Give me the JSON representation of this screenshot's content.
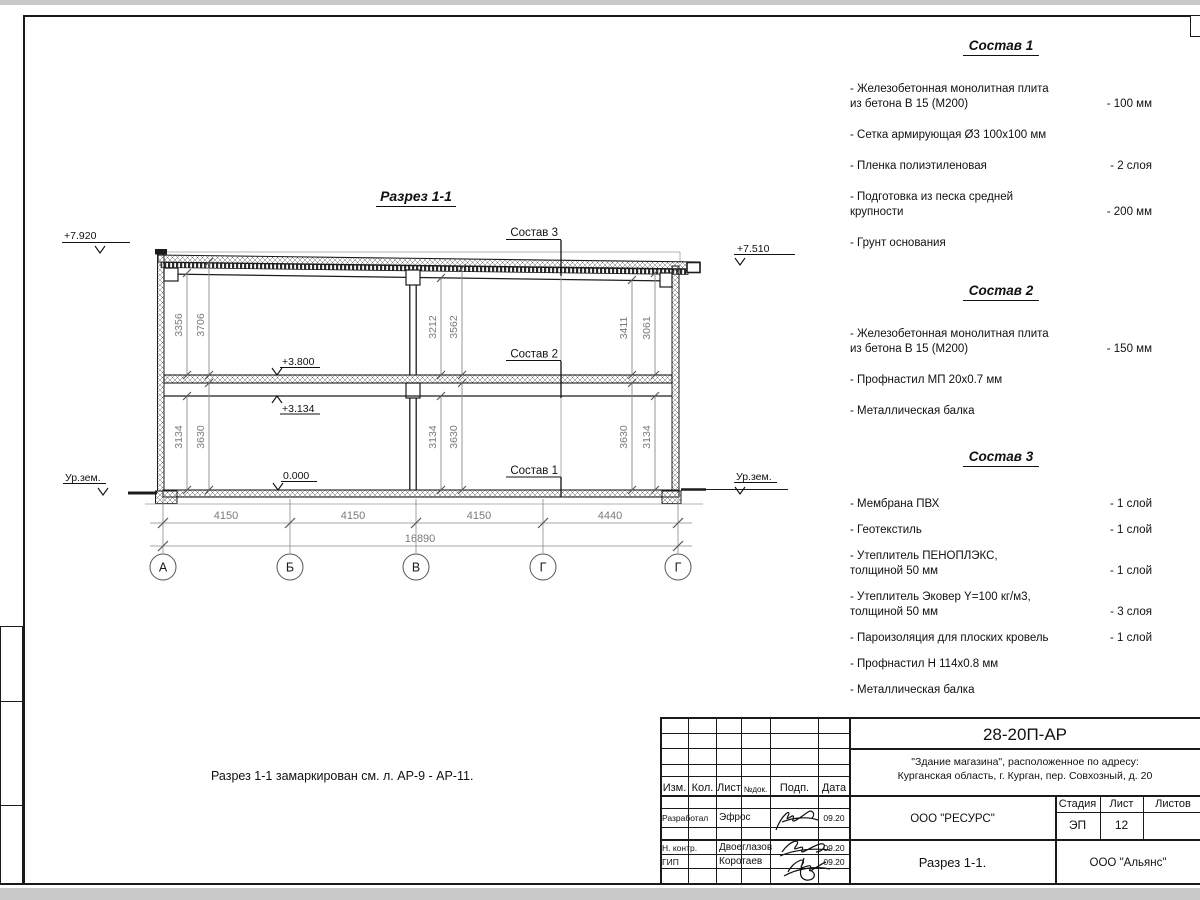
{
  "sheet": {
    "note": "Разрез 1-1 замаркирован см. л. АР-9 - АР-11."
  },
  "section": {
    "title": "Разрез 1-1",
    "levels": {
      "l7920": "+7.920",
      "l7510": "+7.510",
      "l3800": "+3.800",
      "l3134": "+3.134",
      "l0000": "0.000",
      "ground_left": "Ур.зем.",
      "ground_right": "Ур.зем."
    },
    "callouts": {
      "c1": "Состав 1",
      "c2": "Состав 2",
      "c3": "Состав 3"
    },
    "vdims": {
      "lu1": "3356",
      "lu2": "3706",
      "mu1": "3212",
      "mu2": "3562",
      "ru1": "3411",
      "ru2": "3061",
      "ll1": "3134",
      "ll2": "3630",
      "ml1": "3134",
      "ml2": "3630",
      "rl1": "3630",
      "rl2": "3134"
    },
    "hdims": {
      "d1": "4150",
      "d2": "4150",
      "d3": "4150",
      "d4": "4440",
      "total": "16890"
    },
    "axes": {
      "a1": "А",
      "a2": "Б",
      "a3": "В",
      "a4": "Г",
      "a5": "Г"
    }
  },
  "compositions": [
    {
      "title": "Состав 1",
      "items": [
        {
          "text": "- Железобетонная  монолитная плита\nиз бетона В 15 (М200)",
          "value": "- 100 мм"
        },
        {
          "text": "- Сетка армирующая Ø3 100х100 мм",
          "value": ""
        },
        {
          "text": "- Пленка полиэтиленовая",
          "value": "-  2 слоя"
        },
        {
          "text": "- Подготовка из песка средней\nкрупности",
          "value": "- 200 мм"
        },
        {
          "text": "- Грунт основания",
          "value": ""
        }
      ]
    },
    {
      "title": "Состав 2",
      "items": [
        {
          "text": "- Железобетонная  монолитная плита\nиз бетона В 15 (М200)",
          "value": "- 150 мм"
        },
        {
          "text": "- Профнастил МП 20х0.7 мм",
          "value": ""
        },
        {
          "text": "- Металлическая балка",
          "value": ""
        }
      ]
    },
    {
      "title": "Состав 3",
      "items": [
        {
          "text": "- Мембрана ПВХ",
          "value": "- 1 слой"
        },
        {
          "text": "- Геотекстиль",
          "value": "- 1 слой"
        },
        {
          "text": "- Утеплитель ПЕНОПЛЭКС,\nтолщиной 50 мм",
          "value": "- 1 слой"
        },
        {
          "text": "- Утеплитель Эковер Y=100 кг/м3,\nтолщиной 50 мм",
          "value": "- 3 слоя"
        },
        {
          "text": "- Пароизоляция для плоских кровель",
          "value": "- 1 слой"
        },
        {
          "text": "- Профнастил Н 114х0.8 мм",
          "value": ""
        },
        {
          "text": "- Металлическая балка",
          "value": ""
        }
      ]
    }
  ],
  "titleblock": {
    "doc_number": "28-20П-АР",
    "object_line1": "\"Здание магазина\", расположенное по адресу:",
    "object_line2": "Курганская область, г. Курган, пер. Совхозный, д. 20",
    "org": "ООО \"РЕСУРС\"",
    "sheet_name": "Разрез 1-1.",
    "contractor": "ООО \"Альянс\"",
    "stage_label": "Стадия",
    "sheet_label": "Лист",
    "sheets_label": "Листов",
    "stage_value": "ЭП",
    "sheet_value": "12",
    "headers": {
      "izm": "Изм.",
      "kol": "Кол.",
      "list": "Лист",
      "ndok": "№док.",
      "podp": "Подп.",
      "data": "Дата"
    },
    "rows": [
      {
        "role": "Разработал",
        "name": "Эфрос",
        "date": "09.20"
      },
      {
        "role": "Н. контр.",
        "name": "Двоеглазов",
        "date": "09.20"
      },
      {
        "role": "ГИП",
        "name": "Коротаев",
        "date": "09.20"
      }
    ]
  }
}
